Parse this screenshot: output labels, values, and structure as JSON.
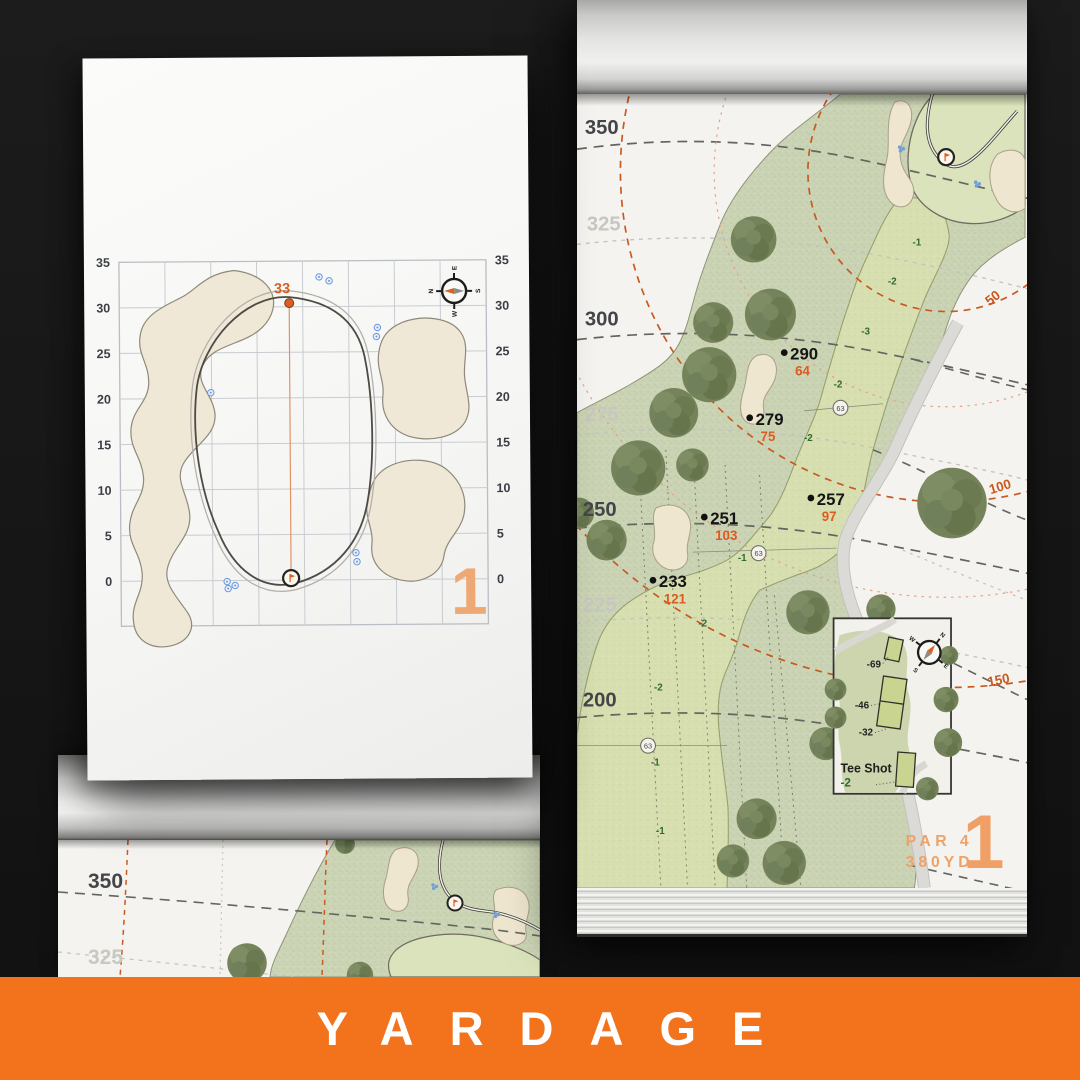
{
  "scene": {
    "banner_title": "YARDAGE",
    "accent_color": "#F2731C"
  },
  "icons": {
    "compass": "compass-rose-icon",
    "pin_flag": "pin-flag-icon",
    "sprinkler_head": "sprinkler-head-icon",
    "sprinkler_dot": "sprinkler-dot-icon",
    "tree": "tree-icon"
  },
  "green_page": {
    "hole_number": "1",
    "pin_distance": "33",
    "axis_left": [
      "35",
      "30",
      "25",
      "20",
      "15",
      "10",
      "5",
      "0"
    ],
    "axis_right": [
      "35",
      "30",
      "25",
      "20",
      "15",
      "10",
      "5",
      "0"
    ],
    "compass": {
      "n": "N",
      "e": "E",
      "s": "S",
      "w": "W"
    }
  },
  "hole_page": {
    "hole_number": "1",
    "par_label": "PAR 4",
    "yardage_label": "380YD",
    "distance_labels": [
      {
        "text": "350",
        "strong": true
      },
      {
        "text": "325",
        "strong": false
      },
      {
        "text": "300",
        "strong": true
      },
      {
        "text": "275",
        "strong": false
      },
      {
        "text": "250",
        "strong": true
      },
      {
        "text": "225",
        "strong": false
      },
      {
        "text": "200",
        "strong": true
      }
    ],
    "carry_markers": [
      {
        "carry": "290",
        "remaining": "64"
      },
      {
        "carry": "279",
        "remaining": "75"
      },
      {
        "carry": "257",
        "remaining": "97"
      },
      {
        "carry": "251",
        "remaining": "103"
      },
      {
        "carry": "233",
        "remaining": "121"
      }
    ],
    "arc_labels": [
      "50",
      "100",
      "150"
    ],
    "slope_labels": [
      "-1",
      "-2",
      "-3",
      "-2",
      "-2",
      "-1",
      "-2",
      "-2",
      "-1",
      "-1"
    ],
    "sprinkler_heads": [
      "63",
      "63",
      "63"
    ],
    "tee_inset": {
      "title": "Tee Shot",
      "slope": "-2",
      "offsets": [
        "-69",
        "-46",
        "-32"
      ],
      "compass": {
        "n": "N",
        "e": "E",
        "s": "S",
        "w": "W"
      }
    }
  },
  "under_page": {
    "distance_labels": [
      {
        "text": "350",
        "strong": true
      },
      {
        "text": "325",
        "strong": false
      }
    ]
  }
}
